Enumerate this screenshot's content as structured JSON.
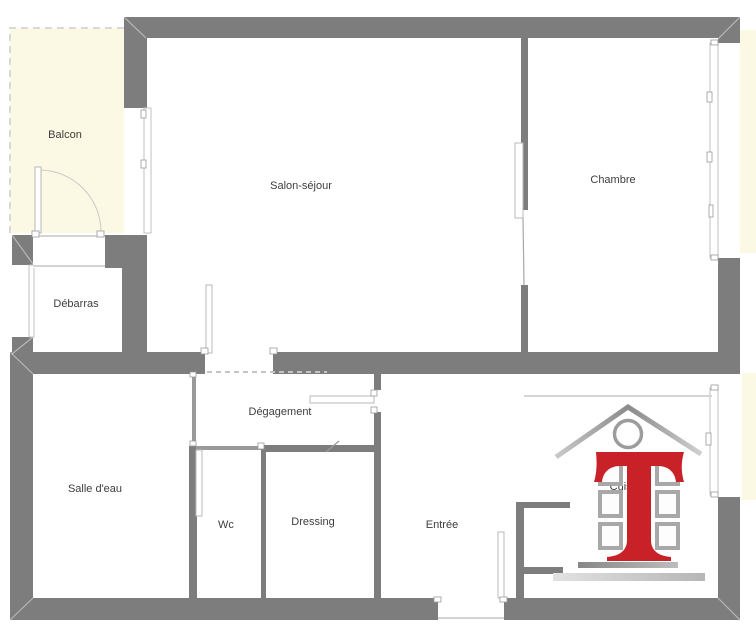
{
  "plan_title": "Apartment floor plan",
  "colors": {
    "wall": "#7d7d7d",
    "wall_light": "#9a9a9a",
    "balcony": "#fbf8e3",
    "label": "#3d3d3d",
    "window_frame": "#c0c0c0",
    "logo_red": "#c92128"
  },
  "rooms": {
    "balcon": {
      "label": "Balcon"
    },
    "salon": {
      "label": "Salon-séjour"
    },
    "chambre": {
      "label": "Chambre"
    },
    "debarras": {
      "label": "Débarras"
    },
    "degagement": {
      "label": "Dégagement"
    },
    "salle_deau": {
      "label": "Salle d'eau"
    },
    "wc": {
      "label": "Wc"
    },
    "dressing": {
      "label": "Dressing"
    },
    "entree": {
      "label": "Entrée"
    },
    "cuisine": {
      "label": "Cuisine"
    }
  },
  "logo": {
    "letter": "T",
    "description": "red serif T with house roof, circle and building windows"
  }
}
